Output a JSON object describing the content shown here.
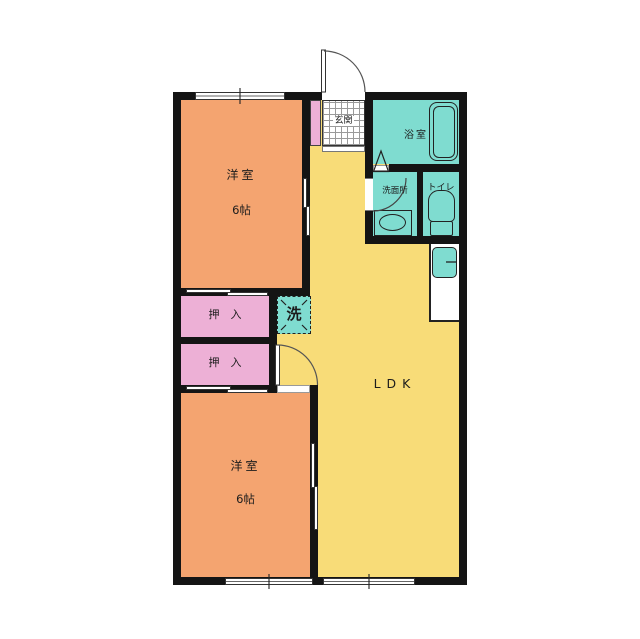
{
  "floor_plan": {
    "title": "2LDK apartment floor plan",
    "rooms": {
      "bedroom_upper": {
        "name": "洋室",
        "size": "6帖"
      },
      "bedroom_lower": {
        "name": "洋室",
        "size": "6帖"
      },
      "closet_upper": {
        "name": "押　入"
      },
      "closet_lower": {
        "name": "押　入"
      },
      "entrance": {
        "name": "玄関"
      },
      "bathroom": {
        "name": "浴室"
      },
      "washroom": {
        "name": "洗面所"
      },
      "toilet": {
        "name": "トイレ"
      },
      "laundry": {
        "name": "洗"
      },
      "ldk": {
        "name": "LDK"
      }
    },
    "colors": {
      "bedroom": "#F4A470",
      "ldk": "#F8DC78",
      "closet": "#EDB0D6",
      "wet_area": "#7FDCD0",
      "wall": "#141414",
      "background": "#FFFFFF"
    }
  }
}
